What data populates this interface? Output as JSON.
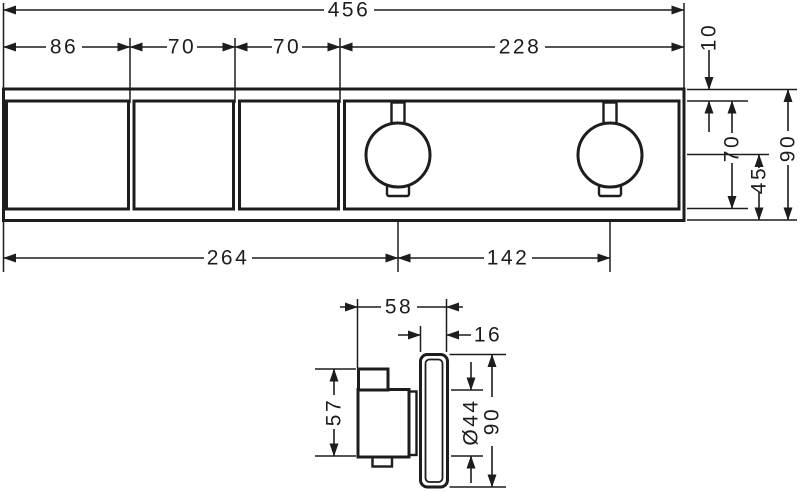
{
  "drawing": {
    "front": {
      "total_width": "456",
      "seg_86": "86",
      "seg_70a": "70",
      "seg_70b": "70",
      "seg_228": "228",
      "edge_inset": "10",
      "inner_height": "70",
      "knob_center_to_bottom": "45",
      "total_height": "90",
      "left_to_knob": "264",
      "knob_spacing": "142"
    },
    "side": {
      "total_depth": "58",
      "plate_depth": "16",
      "valve_height": "57",
      "knob_diameter": "Ø44",
      "plate_height": "90"
    }
  }
}
